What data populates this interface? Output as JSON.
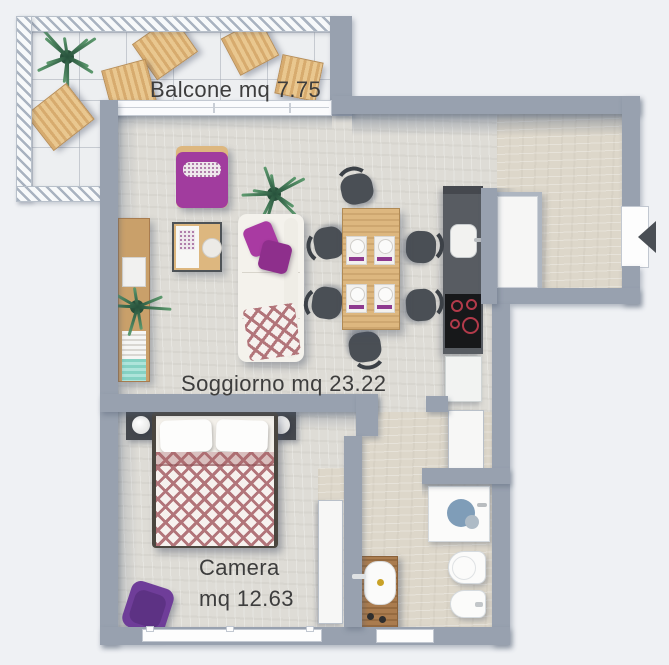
{
  "scene": {
    "background": "#eff1f4",
    "wall": "#98a1af",
    "floor_main": "#dedcd6",
    "floor_entry": "#ddd7ca",
    "floor_balcony": "#edeff1",
    "label_color": "#3d3d3d"
  },
  "palette": {
    "purple_dark": "#5f2b59",
    "magenta": "#a93aa2",
    "violet": "#6f3d99",
    "wood": "#ddb77f",
    "wood_dark": "#aa7c4f",
    "rose": "#b2757a",
    "teal": "#85d2c3",
    "cooktop_red": "#b23a4a",
    "shower_blue": "#7f9db8",
    "chair_gray": "#4a4f55",
    "counter_gray": "#585c62",
    "arrow": "#4a4f55"
  },
  "labels": {
    "balcone": "Balcone mq 7.75",
    "soggiorno": "Soggiorno mq 23.22",
    "camera_line1": "Camera",
    "camera_line2": "mq 12.63"
  }
}
